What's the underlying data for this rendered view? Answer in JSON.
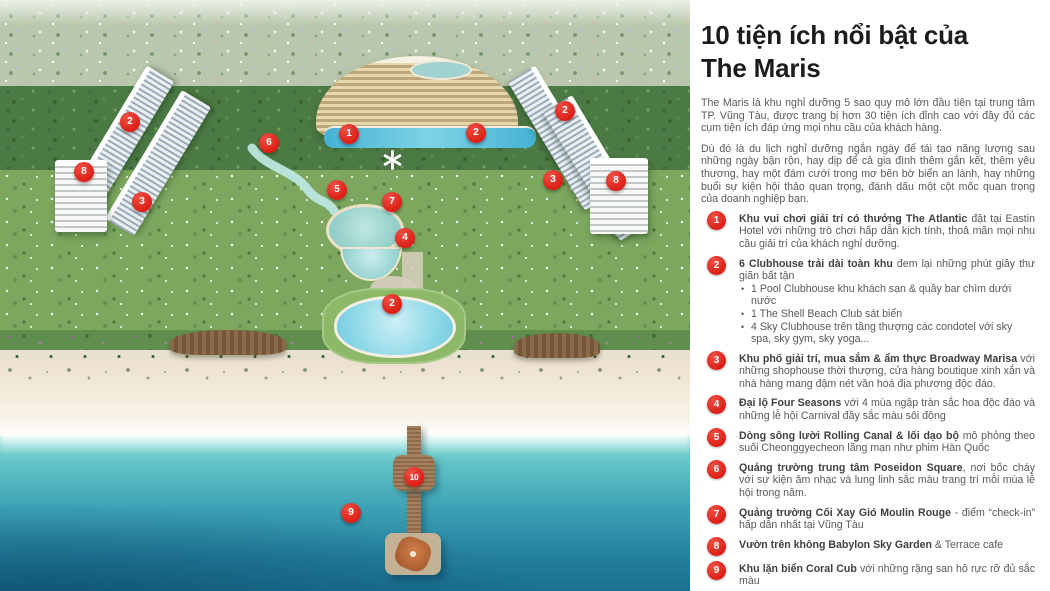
{
  "panel": {
    "title_line1": "10 tiện ích nổi bật của",
    "title_line2": "The Maris",
    "intro1": "The Maris là khu nghỉ dưỡng 5 sao quy mô lớn đầu tiên tại trung tâm TP. Vũng Tàu, được trang bị hơn 30 tiện ích đỉnh cao với đầy đủ các cụm tiện ích đáp ứng mọi nhu cầu của khách hàng.",
    "intro2": "Dù đó là du lịch nghỉ dưỡng ngắn ngày để tái tạo năng lượng sau những ngày bận rộn, hay dịp để cả gia đình thêm gắn kết, thêm yêu thương, hay một đám cưới trong mơ bên bờ biển an lành, hay những buổi sự kiện hội thảo quan trọng, đánh dấu một cột mốc quan trọng của doanh nghiệp bạn.",
    "items": [
      {
        "num": "1",
        "bold": "Khu vui chơi giải trí có thưởng The Atlantic",
        "rest": " đặt tại Eastin Hotel với những trò chơi hấp dẫn kịch tính, thoả mãn mọi nhu cầu giải trí của khách nghỉ dưỡng.",
        "bullets": []
      },
      {
        "num": "2",
        "bold": "6 Clubhouse trải dài toàn khu",
        "rest": " đem lại những phút giây thư giãn bất tận",
        "bullets": [
          "1 Pool Clubhouse khu khách sạn & quầy bar chìm dưới nước",
          "1 The Shell Beach Club sát biển",
          "4 Sky Clubhouse trên tầng thượng các condotel với sky spa, sky gym, sky yoga..."
        ]
      },
      {
        "num": "3",
        "bold": "Khu phố giải trí, mua sắm & ẩm thực Broadway Marisa",
        "rest": " với những shophouse thời thượng, cửa hàng boutique xinh xắn và nhà hàng mang đậm nét văn hoá địa phương độc đáo.",
        "bullets": []
      },
      {
        "num": "4",
        "bold": "Đại lộ Four Seasons",
        "rest": " với 4 mùa ngập tràn sắc hoa độc đáo và những lễ hội Carnival đầy sắc màu sôi động",
        "bullets": []
      },
      {
        "num": "5",
        "bold": "Dòng sông lười Rolling Canal & lối dạo bộ",
        "rest": " mô phỏng theo suối Cheonggyecheon lãng mạn như phim Hàn Quốc",
        "bullets": []
      },
      {
        "num": "6",
        "bold": "Quảng trường trung tâm Poseidon Square",
        "rest": ", nơi bốc cháy với sự kiện âm nhạc và lung linh sắc màu trang trí mỗi mùa lễ hội trong năm.",
        "bullets": []
      },
      {
        "num": "7",
        "bold": "Quảng trường Cối Xay Gió Moulin Rouge",
        "rest": " - điểm “check-in” hấp dẫn nhất tại Vũng Tàu",
        "bullets": []
      },
      {
        "num": "8",
        "bold": "Vườn trên không Babylon Sky Garden",
        "rest": " & Terrace cafe",
        "bullets": []
      },
      {
        "num": "9",
        "bold": "Khu lặn biển Coral Cub",
        "rest": " với những rặng san hô rực rỡ đủ sắc màu",
        "bullets": []
      },
      {
        "num": "10",
        "bold": "Cầu tàu Huntington California & Bến du thuyền",
        "rest": " lãng mạn cho những cặp đôi đang yêu",
        "bullets": []
      }
    ]
  },
  "map": {
    "marker_color": "#dc1f16",
    "markers": [
      {
        "label": "1",
        "x": 349,
        "y": 134
      },
      {
        "label": "2",
        "x": 130,
        "y": 122
      },
      {
        "label": "2",
        "x": 476,
        "y": 133
      },
      {
        "label": "2",
        "x": 565,
        "y": 111
      },
      {
        "label": "2",
        "x": 392,
        "y": 304
      },
      {
        "label": "3",
        "x": 142,
        "y": 202
      },
      {
        "label": "3",
        "x": 553,
        "y": 180
      },
      {
        "label": "4",
        "x": 405,
        "y": 238
      },
      {
        "label": "5",
        "x": 337,
        "y": 190
      },
      {
        "label": "6",
        "x": 269,
        "y": 143
      },
      {
        "label": "7",
        "x": 392,
        "y": 202
      },
      {
        "label": "8",
        "x": 84,
        "y": 172
      },
      {
        "label": "8",
        "x": 616,
        "y": 181
      },
      {
        "label": "9",
        "x": 351,
        "y": 513
      },
      {
        "label": "10",
        "x": 414,
        "y": 477
      }
    ]
  },
  "colors": {
    "accent_red": "#dc1f16",
    "title_text": "#1c1c1e",
    "body_text": "#58595b",
    "sea_deep": "#1a7090",
    "sea_light": "#90ddd8",
    "sand": "#f2e9d8",
    "panel_bg": "#ffffff"
  }
}
